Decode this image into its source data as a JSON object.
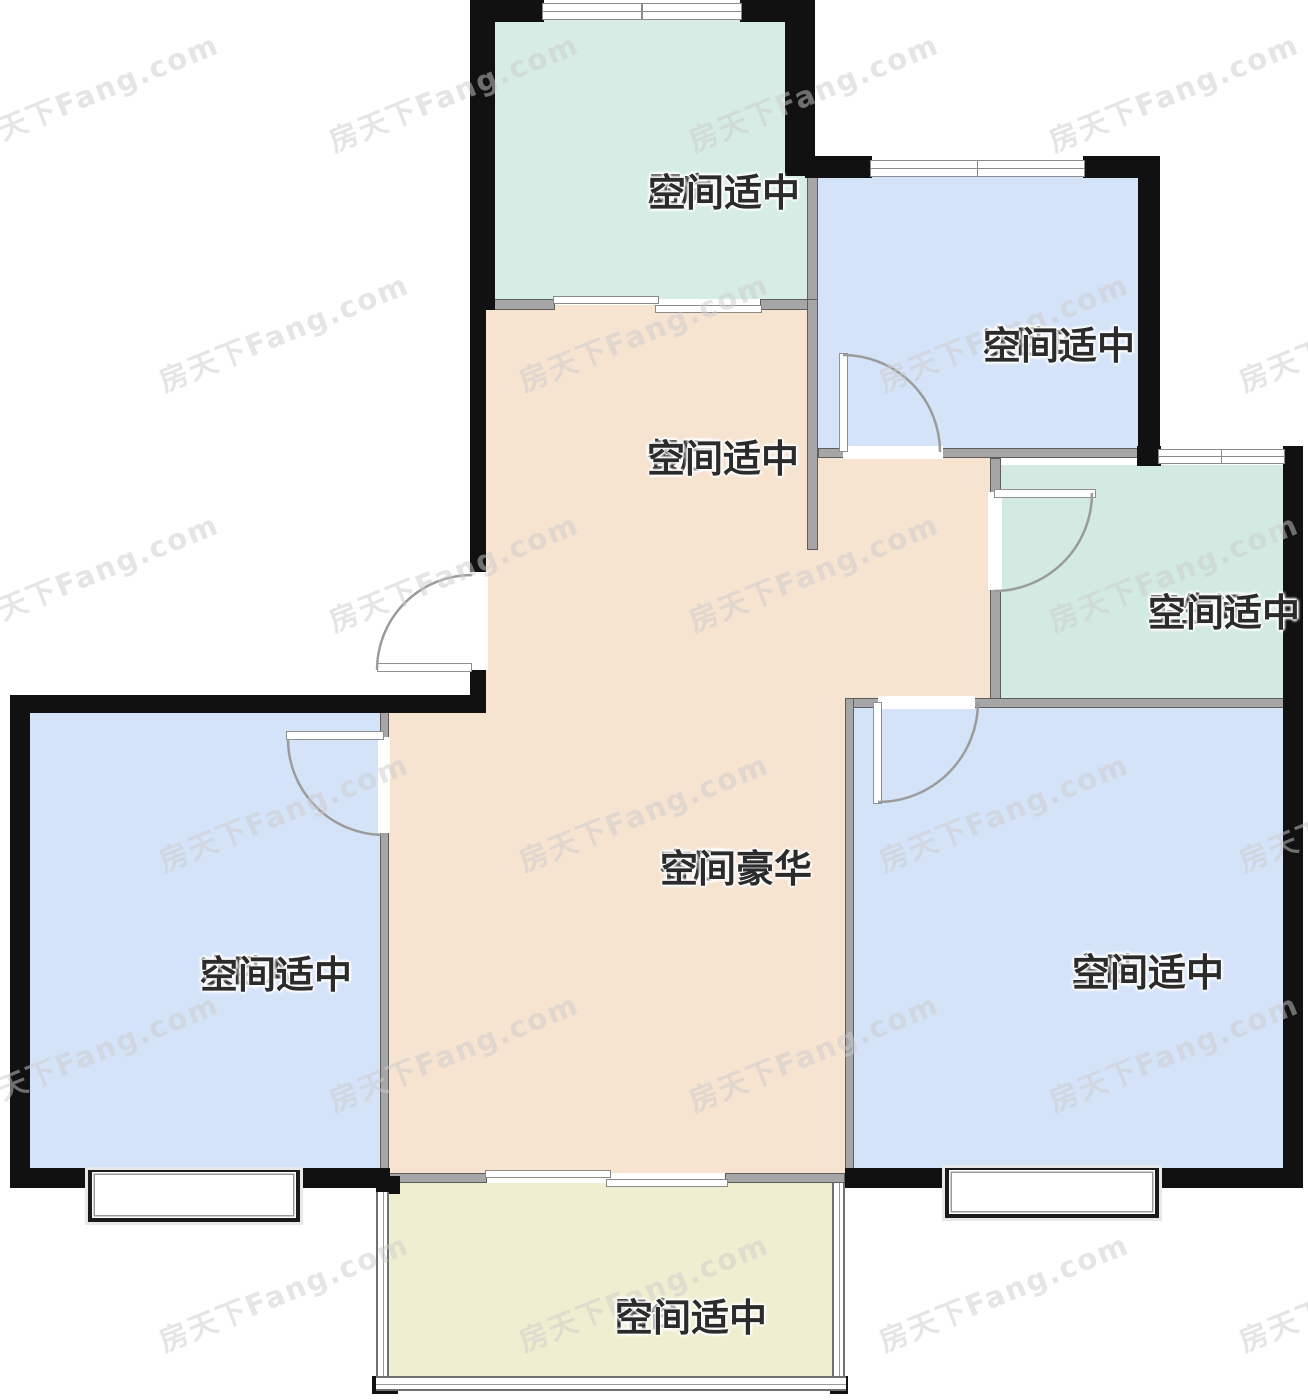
{
  "watermark": {
    "text": "房天下Fang.com"
  },
  "rooms": [
    {
      "name": "厨房",
      "desc": "空间适中"
    },
    {
      "name": "次卧B",
      "desc": "空间适中"
    },
    {
      "name": "餐厅",
      "desc": "空间适中"
    },
    {
      "name": "卫生间",
      "desc": "空间适中"
    },
    {
      "name": "客厅",
      "desc": "空间豪华"
    },
    {
      "name": "次卧A",
      "desc": "空间适中"
    },
    {
      "name": "主卧",
      "desc": "空间适中"
    },
    {
      "name": "阳台",
      "desc": "空间适中"
    }
  ],
  "colors": {
    "wall": "#111111",
    "iwall": "#a6a6a6",
    "iwallEdge": "#5e5e5e",
    "kitchen": "#d6ece5",
    "bath": "#d2eae2",
    "bedroom": "#d5e3f9",
    "living": "#f6e3d0",
    "balcony": "#f0eed0",
    "text": "#2b2b2b",
    "watermark": "#cdcdcd",
    "doorline": "#9b9b9b"
  }
}
